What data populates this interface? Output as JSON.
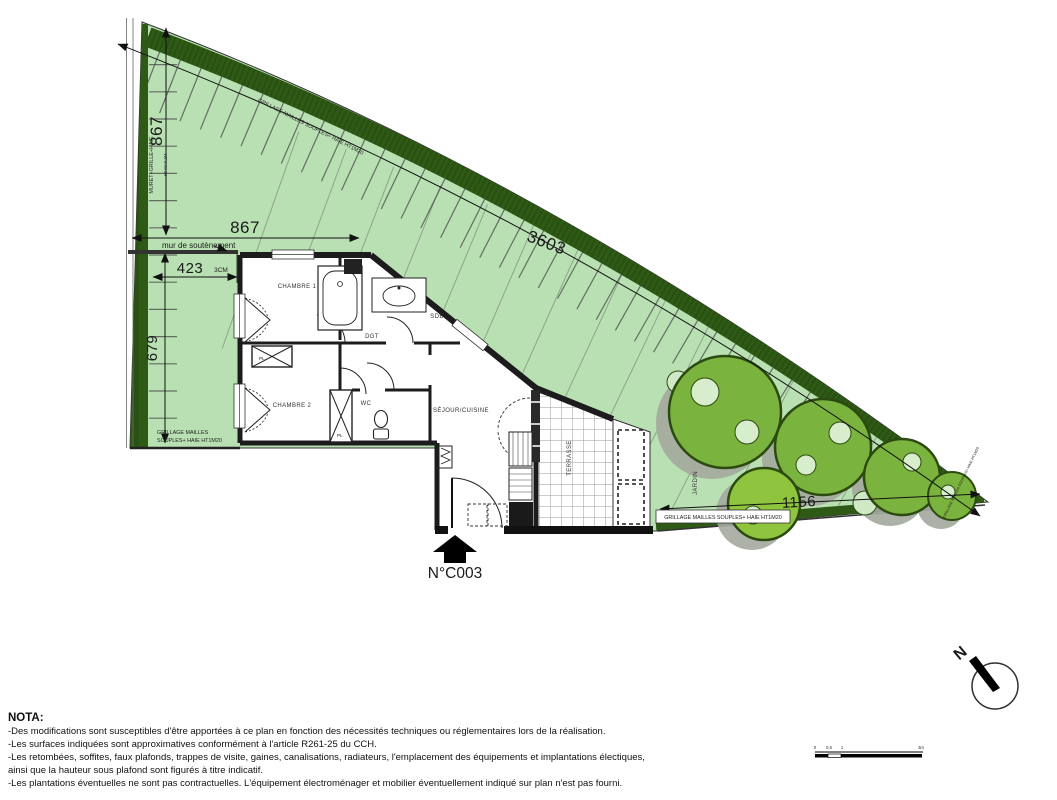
{
  "title_block": {
    "unit_number": "N°C003"
  },
  "dimensions": {
    "left_upper": "867",
    "top": "867",
    "inner": "423",
    "offset": "3CM",
    "left_lower": "679",
    "diagonal": "3603",
    "bottom_right": "1156"
  },
  "rooms": {
    "chambre1": "CHAMBRE 1",
    "chambre2": "CHAMBRE 2",
    "sdb": "SDB",
    "dgt": "DGT",
    "wc": "WC",
    "sejour": "SÉJOUR/CUISINE",
    "terrasse": "TERRASSE",
    "jardin": "JARDIN",
    "pl1": "PL",
    "pl2": "PL"
  },
  "boundaries": {
    "muret_line1": "MURET+GRILLE+HAIE",
    "muret_line2": "HT MAX 2M",
    "retaining_wall": "mur de soutènement",
    "fence_left_line1": "GRILLAGE MAILLES",
    "fence_left_line2": "SOUPLES+ HAIE HT1M20",
    "fence_bottom": "GRILLAGE MAILLES SOUPLES+ HAIE HT1M20",
    "fence_diagonal": "GRILLAGE MAILLES SOUPLES+ HAIE HT1M20",
    "fence_tip": "GRILLAGE MAILLES SOUPLES+ HAIE HT1M20"
  },
  "compass": {
    "north": "N"
  },
  "scale_bar": {
    "t0": "0",
    "t05": "0.5",
    "t1": "1",
    "t3": "3m"
  },
  "nota": {
    "title": "NOTA:",
    "lines": [
      "-Des modifications sont susceptibles d'être apportées à ce plan en fonction des nécessités techniques ou réglementaires lors de la réalisation.",
      "-Les surfaces indiquées sont approximatives conformément à l'article R261-25 du CCH.",
      "-Les retombées, soffites, faux plafonds, trappes de visite, gaines, canalisations, radiateurs, l'emplacement des équipements et implantations électiques,",
      "ainsi que la hauteur sous plafond sont figurés à titre indicatif.",
      "-Les plantations éventuelles ne sont pas contractuelles. L'équipement électroménager et mobilier éventuellement indiqué sur plan n'est pas fourni."
    ]
  },
  "colors": {
    "garden": "#b9e0b3",
    "hedge": "#2f5a16",
    "tree": "#7ab43e",
    "tree_light": "#8fc43f",
    "wall": "#1c1c1c"
  }
}
